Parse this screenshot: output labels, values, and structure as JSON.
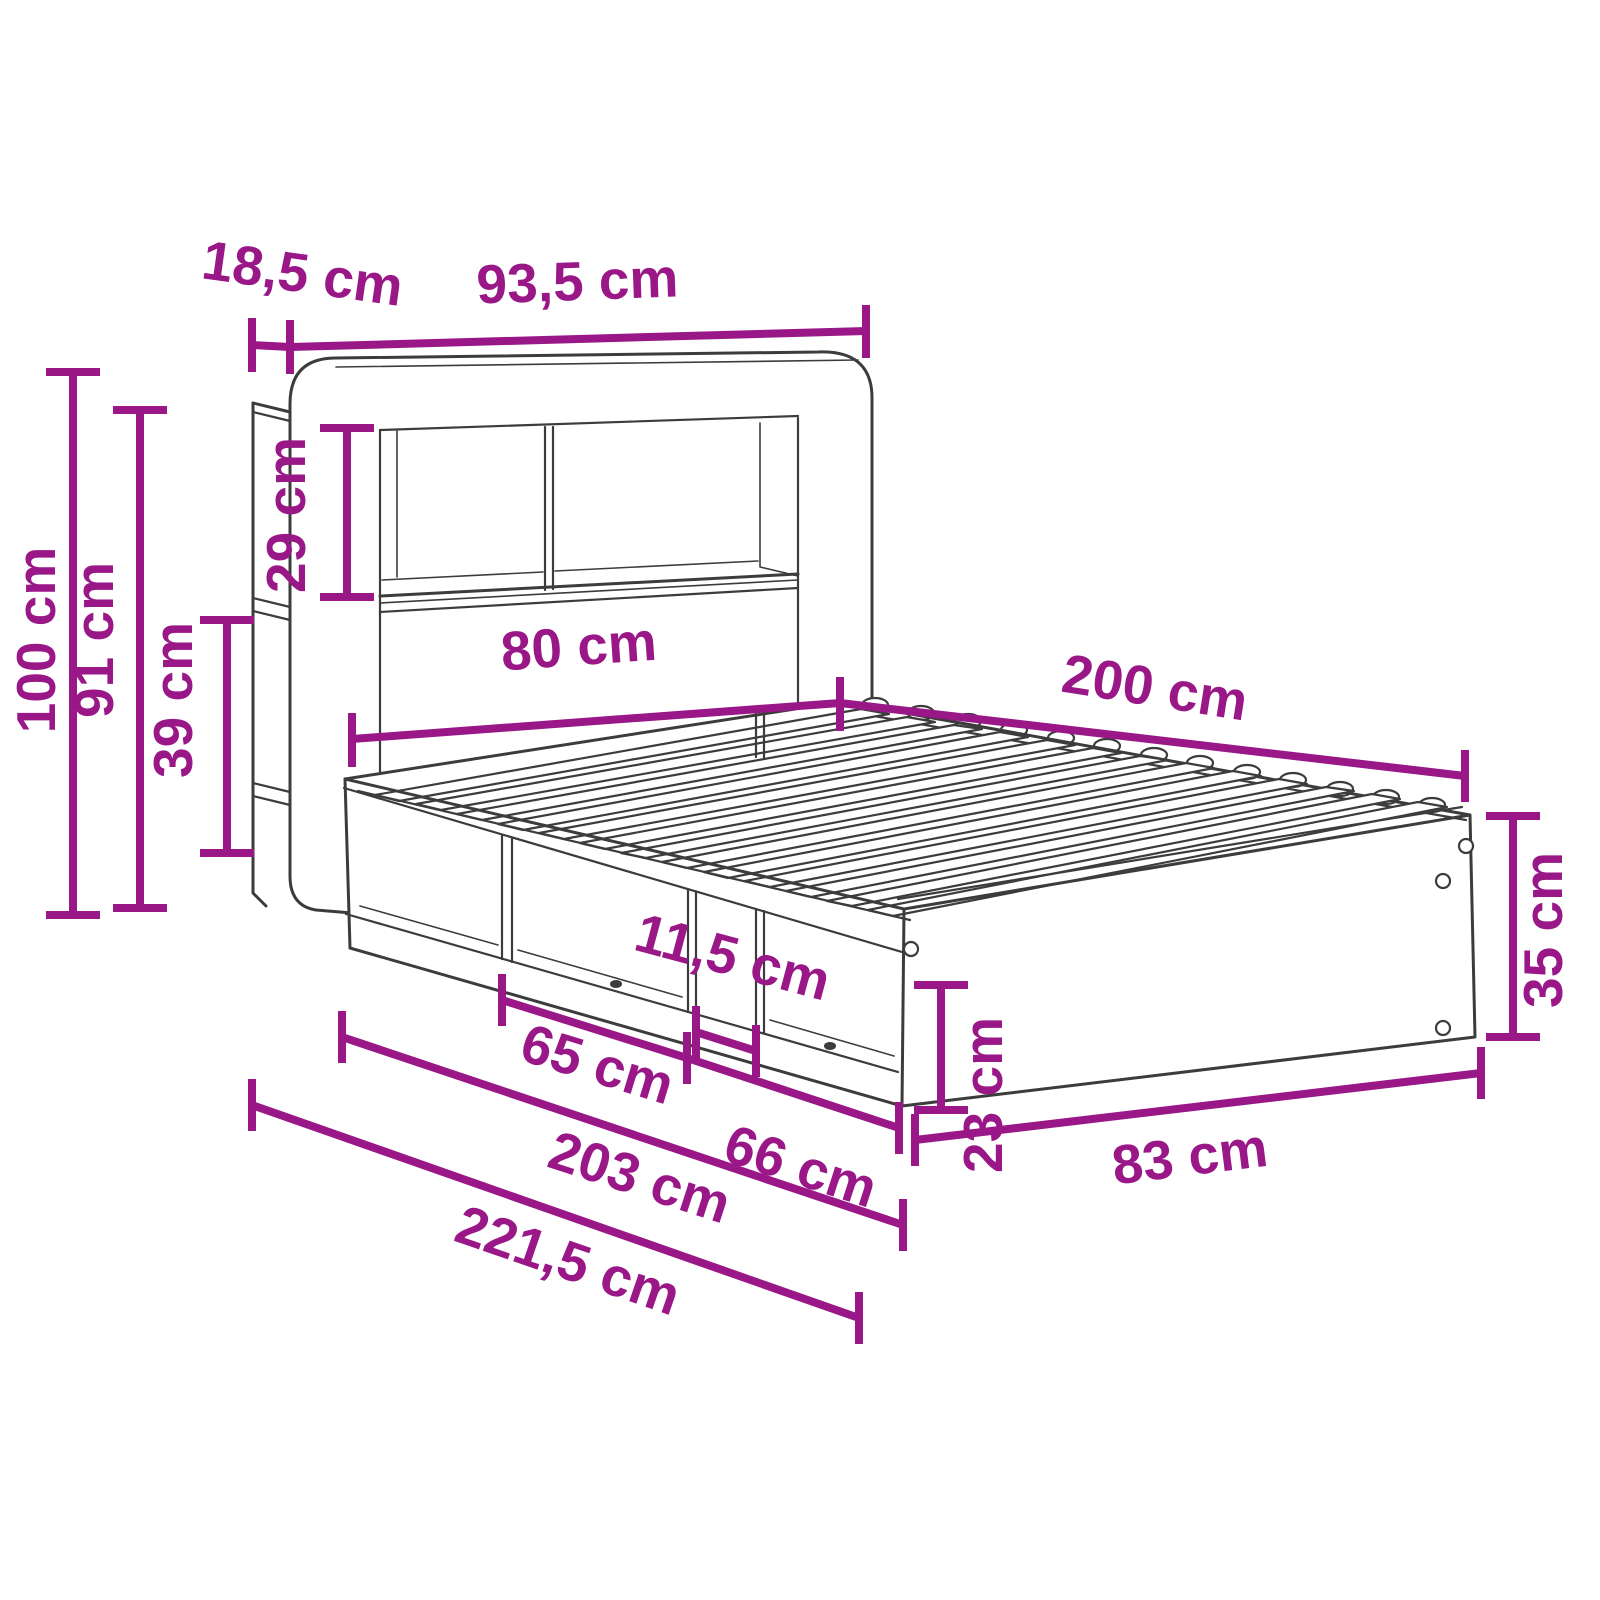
{
  "diagram": {
    "type": "furniture-dimension-drawing",
    "subject": "bed frame with bookcase headboard and under-bed storage",
    "unit": "cm",
    "accent_color": "#9A1788",
    "line_color": "#3C3C3C",
    "background_color": "#FFFFFF"
  },
  "dimensions": {
    "side_shelf_depth": {
      "label": "18,5 cm",
      "value": 18.5,
      "orientation": "horizontal"
    },
    "headboard_width": {
      "label": "93,5 cm",
      "value": 93.5,
      "orientation": "horizontal"
    },
    "total_height": {
      "label": "100 cm",
      "value": 100,
      "orientation": "vertical"
    },
    "headboard_height": {
      "label": "91 cm",
      "value": 91,
      "orientation": "vertical"
    },
    "upper_shelf_height": {
      "label": "29 cm",
      "value": 29,
      "orientation": "vertical"
    },
    "lower_shelf_height": {
      "label": "39 cm",
      "value": 39,
      "orientation": "vertical"
    },
    "bed_width": {
      "label": "80 cm",
      "value": 80,
      "orientation": "horizontal"
    },
    "bed_length": {
      "label": "200 cm",
      "value": 200,
      "orientation": "horizontal"
    },
    "divider_width": {
      "label": "11,5 cm",
      "value": 11.5,
      "orientation": "horizontal"
    },
    "cubby_left_width": {
      "label": "65 cm",
      "value": 65,
      "orientation": "horizontal"
    },
    "cubby_right_width": {
      "label": "66 cm",
      "value": 66,
      "orientation": "horizontal"
    },
    "storage_opening_height": {
      "label": "23 cm",
      "value": 23,
      "orientation": "vertical"
    },
    "base_height": {
      "label": "35 cm",
      "value": 35,
      "orientation": "vertical"
    },
    "foot_panel_width": {
      "label": "83 cm",
      "value": 83,
      "orientation": "horizontal"
    },
    "length_with_headboard": {
      "label": "203 cm",
      "value": 203,
      "orientation": "horizontal"
    },
    "total_length": {
      "label": "221,5 cm",
      "value": 221.5,
      "orientation": "horizontal"
    }
  }
}
